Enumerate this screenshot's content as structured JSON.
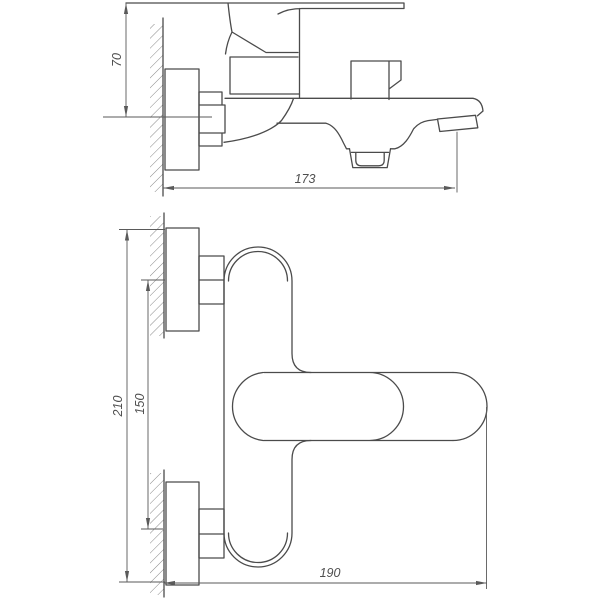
{
  "colors": {
    "background": "#ffffff",
    "line": "#4b4b4b",
    "dimension": "#5a5a5a",
    "text": "#4f4f4f"
  },
  "side_view": {
    "dim_height": "70",
    "dim_depth": "173"
  },
  "plan_view": {
    "dim_overall_height": "210",
    "dim_connection_spacing": "150",
    "dim_depth": "190"
  }
}
